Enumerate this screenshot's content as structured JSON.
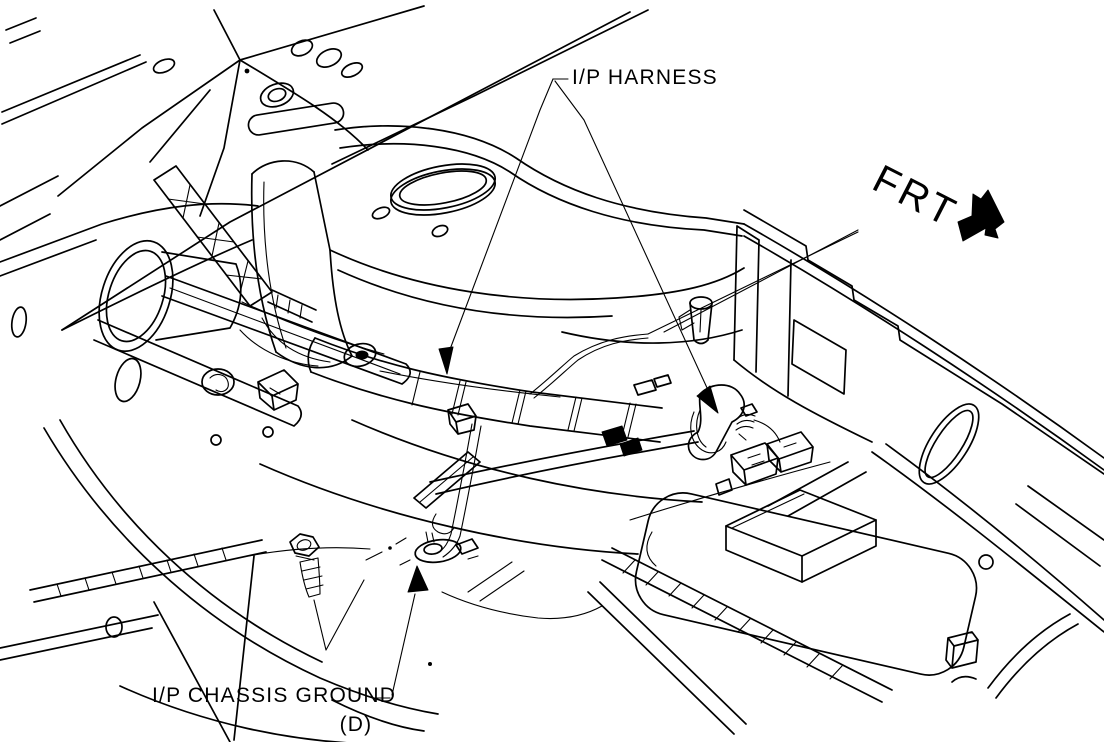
{
  "figure": {
    "background_color": "#ffffff",
    "ink_color": "#000000",
    "labels": {
      "harness": "I/P HARNESS",
      "chassis_ground": "I/P CHASSIS GROUND",
      "chassis_ground_code": "(D)",
      "front_indicator": "FRT"
    },
    "callouts": [
      {
        "text": "I/P HARNESS",
        "arrowheads": 2
      },
      {
        "text": "I/P CHASSIS GROUND (D)",
        "arrowheads": 1
      }
    ],
    "front_arrow_direction": "lower-right"
  }
}
